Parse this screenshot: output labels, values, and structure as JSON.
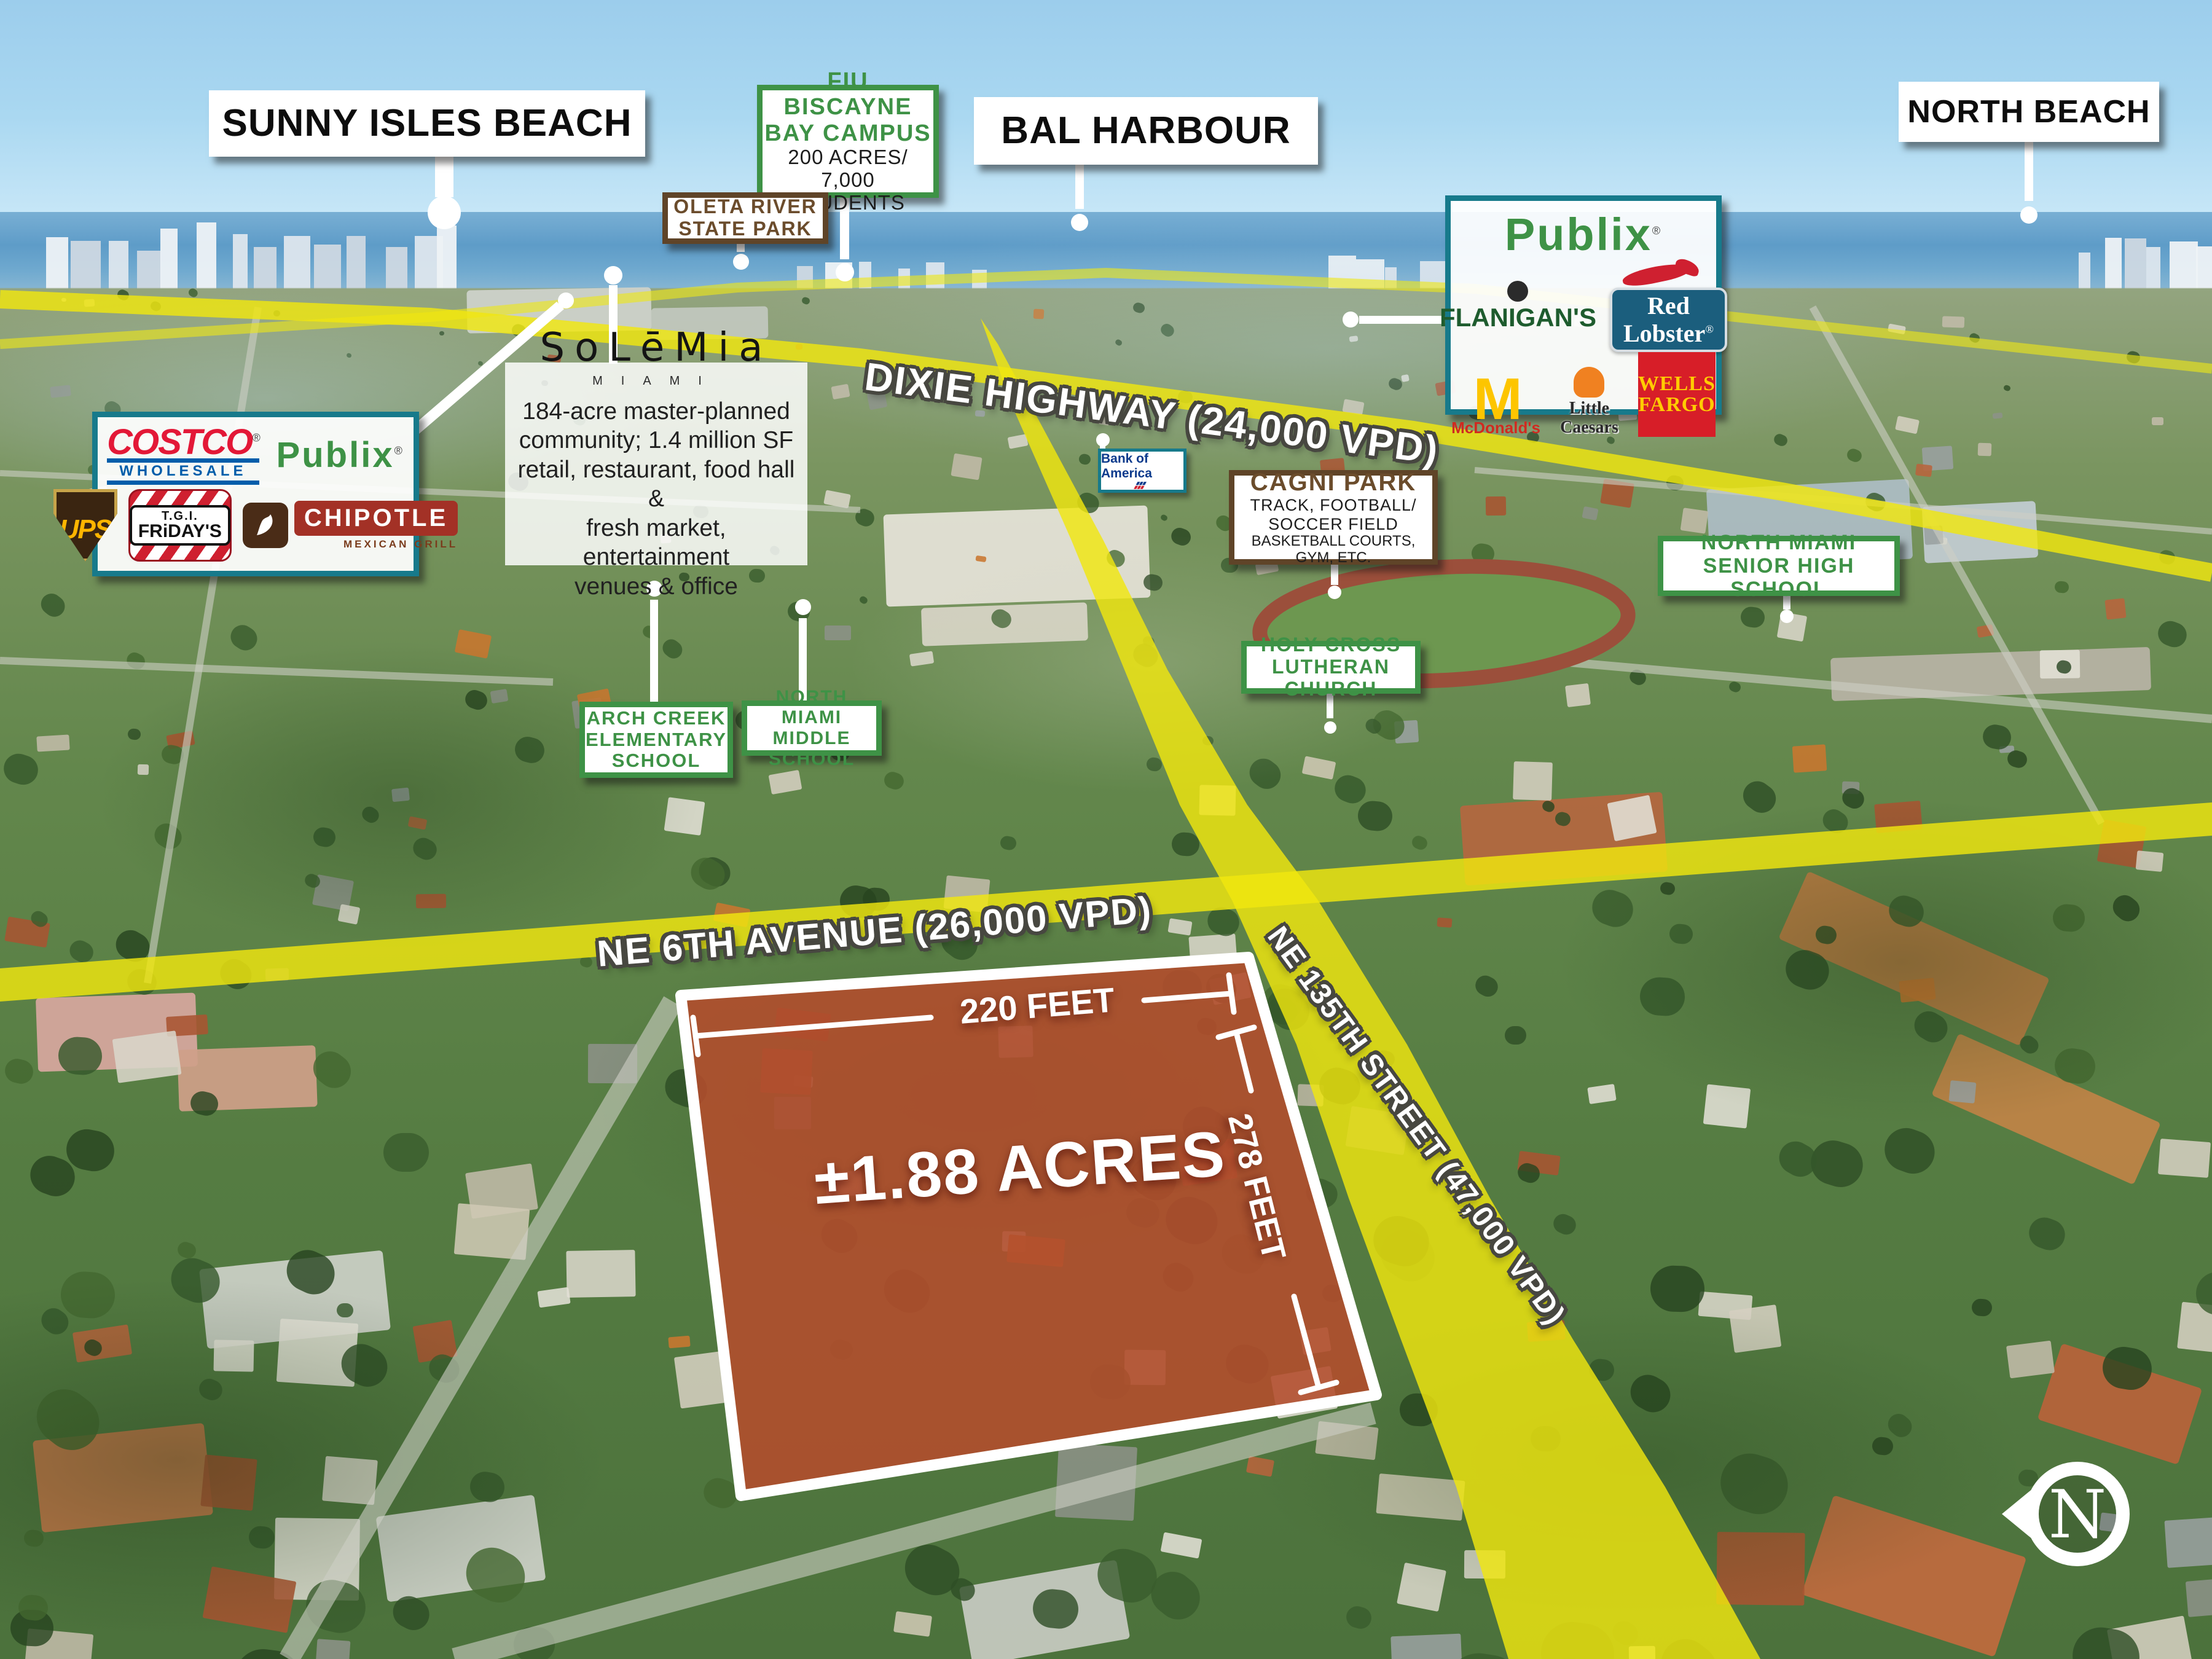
{
  "city_labels": {
    "sunny_isles": "SUNNY ISLES BEACH",
    "bal_harbour": "BAL HARBOUR",
    "north_beach": "NORTH BEACH"
  },
  "fiu": {
    "l1": "FIU BISCAYNE",
    "l2": "BAY CAMPUS",
    "l3": "200 ACRES/",
    "l4": "7,000 STUDENTS"
  },
  "oleta": {
    "l1": "OLETA RIVER",
    "l2": "STATE PARK"
  },
  "cagni": {
    "title": "CAGNI PARK",
    "l1": "TRACK, FOOTBALL/",
    "l2": "SOCCER FIELD",
    "l3": "BASKETBALL COURTS, GYM, ETC."
  },
  "holy_cross": {
    "l1": "HOLY CROSS",
    "l2": "LUTHERAN CHURCH"
  },
  "arch_creek": {
    "l1": "ARCH CREEK",
    "l2": "ELEMENTARY",
    "l3": "SCHOOL"
  },
  "middle_school": {
    "l1": "NORTH MIAMI",
    "l2": "MIDDLE SCHOOL"
  },
  "senior_high": {
    "l1": "NORTH MIAMI",
    "l2": "SENIOR HIGH SCHOOL"
  },
  "solemia": {
    "brand": "SoLēMia",
    "sub": "MIAMI",
    "d1": "184-acre master-planned",
    "d2": "community; 1.4 million SF",
    "d3": "retail, restaurant, food hall &",
    "d4": "fresh market, entertainment",
    "d5": "venues & office"
  },
  "roads": {
    "dixie": "DIXIE HIGHWAY (24,000 VPD)",
    "ne6": "NE 6TH AVENUE (26,000 VPD)",
    "ne135": "NE 135TH STREET (47,000 VPD)"
  },
  "parcel": {
    "acres": "±1.88 ACRES",
    "width_dim": "220 FEET",
    "depth_dim": "278 FEET"
  },
  "west_box": {
    "costco": "COSTCO",
    "costco_sub": "WHOLESALE",
    "publix": "Publix",
    "ups": "UPS",
    "fridays_top": "T.G.I.",
    "fridays_name": "FRiDAY'S",
    "chipotle": "CHIPOTLE",
    "chipotle_sub": "MEXICAN GRILL"
  },
  "east_box": {
    "publix": "Publix",
    "flanigans": "FLANIGAN'S",
    "red_lobster": "Red Lobster",
    "mcdonalds": "McDonald's",
    "little_caesars": "Little Caesars",
    "wells_1": "WELLS",
    "wells_2": "FARGO"
  },
  "bank_of_america": "Bank of America",
  "compass_n": "N",
  "reg_mark": "®",
  "colors": {
    "road_yellow": "#ede714",
    "label_green": "#3e9246",
    "label_brown": "#5f4428",
    "box_teal": "#177a8b",
    "parcel_red": "#a91c08",
    "costco_red": "#e31837",
    "costco_blue": "#005daa",
    "wells_red": "#d71e28",
    "wells_yellow": "#ffcc02",
    "boa_blue": "#0b3a8c",
    "mcd_yellow": "#fdc500",
    "mcd_red": "#d02a20",
    "caesars_orange": "#f08121",
    "redlobster_blue": "#1b5e7d",
    "flanigans_green": "#1e5c2e"
  }
}
